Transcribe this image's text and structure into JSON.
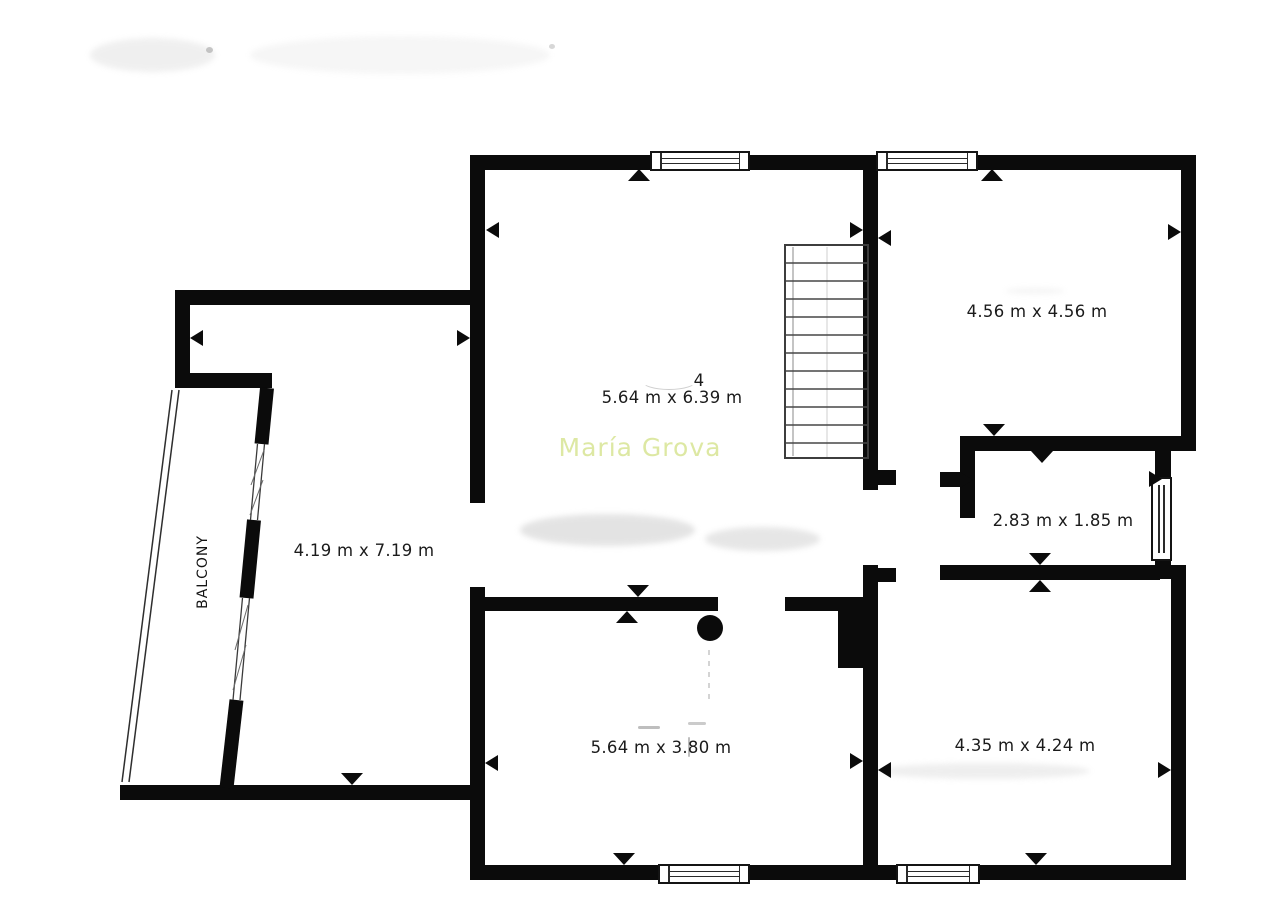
{
  "plan": {
    "watermark": {
      "text": "María Grova",
      "color": "#dde8a3"
    },
    "wall_color": "#0b0b0b",
    "rooms": {
      "main": {
        "number": "4",
        "dims": "5.64 m x 6.39 m"
      },
      "top_right": {
        "dims": "4.56 m x 4.56 m"
      },
      "small": {
        "dims": "2.83 m x 1.85 m"
      },
      "left": {
        "dims": "4.19 m x 7.19 m"
      },
      "balcony": {
        "label": "BALCONY"
      },
      "bottom_center": {
        "dims": "5.64 m x 3.80 m"
      },
      "bottom_right": {
        "dims": "4.35 m x 4.24 m"
      }
    }
  }
}
